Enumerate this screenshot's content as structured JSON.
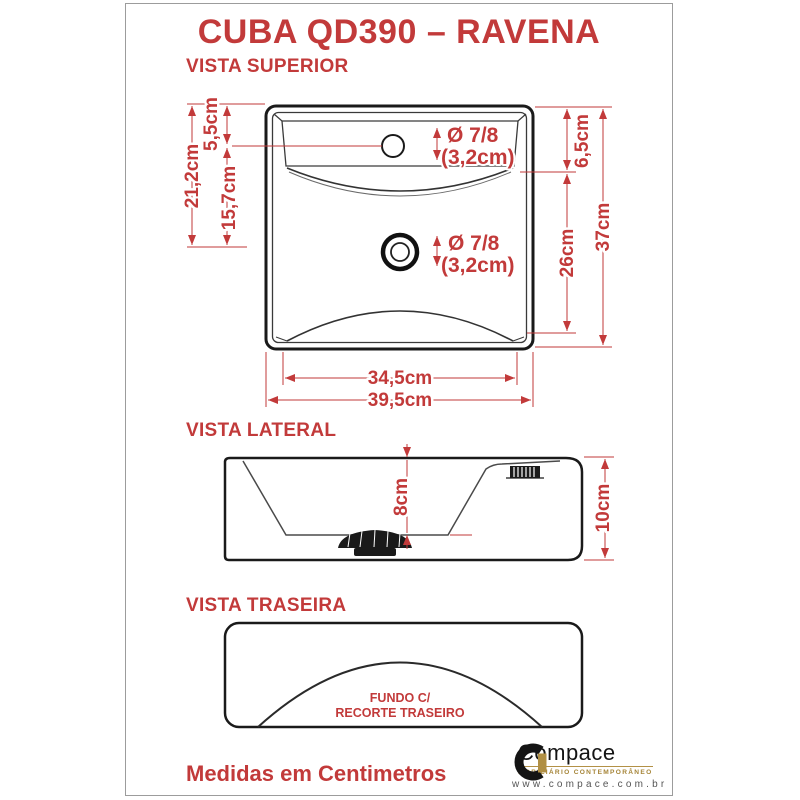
{
  "page": {
    "title": "CUBA QD390 – RAVENA",
    "footer_note": "Medidas em Centimetros"
  },
  "colors": {
    "accent_red": "#c23a3a",
    "drawing_line": "#1a1a1a",
    "frame_gray": "#9c9c9c",
    "logo_gold": "#a58437"
  },
  "views": {
    "superior": {
      "label": "VISTA SUPERIOR",
      "dims": {
        "top_to_faucet": "5,5cm",
        "top_to_drain": "21,2cm",
        "faucet_to_drain": "15,7cm",
        "right_top": "6,5cm",
        "right_mid": "26cm",
        "right_total": "37cm",
        "inner_width": "34,5cm",
        "outer_width": "39,5cm",
        "faucet_dia_line1": "Ø 7/8",
        "faucet_dia_line2": "(3,2cm)",
        "drain_dia_line1": "Ø 7/8",
        "drain_dia_line2": "(3,2cm)"
      }
    },
    "lateral": {
      "label": "VISTA LATERAL",
      "dims": {
        "inner_depth": "8cm",
        "total_height": "10cm"
      }
    },
    "traseira": {
      "label": "VISTA TRASEIRA",
      "note_line1": "FUNDO C/",
      "note_line2": "RECORTE TRASEIRO"
    }
  },
  "logo": {
    "name": "Compace",
    "tagline": "MOBILIÁRIO CONTEMPORÂNEO",
    "url": "www.compace.com.br"
  }
}
